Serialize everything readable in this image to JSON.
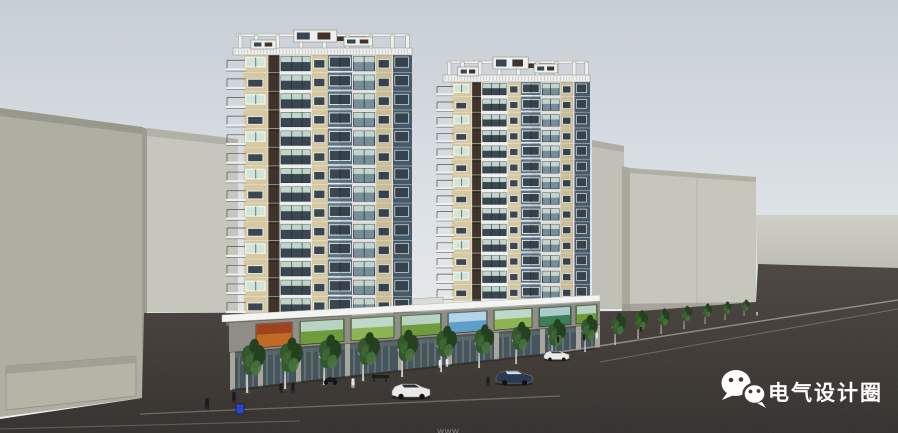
{
  "watermark": {
    "icon": "wechat-icon",
    "text": "电气设计圈",
    "color": "#ffffff"
  },
  "footer": {
    "text": "www"
  },
  "palette": {
    "sky_top": "#c7ced5",
    "sky_mid": "#dde2e6",
    "sky_bottom": "#f0f1f2",
    "ground_light": "#cfcfc8",
    "ground_light2": "#bdbdb4",
    "road_light": "#4a443f",
    "road": "#3f3a36",
    "road_dark": "#322e2b",
    "curb": "#a29d96",
    "block_face": "#aeaea2",
    "block_face_light": "#c6c6bc",
    "block_fascia": "#98988c",
    "block_side": "#9c9c90",
    "tower_tan": "#d6c8a0",
    "panel_brown": "#40332a",
    "panel_blue": "#5d7485",
    "panel_blue_dark": "#4a5f6f",
    "frame_white": "#eef0ef",
    "glass_green": "#cfe5d8",
    "glass_pale": "#dfeee6",
    "glass_dark": "#3a4750",
    "glass_blue": "#7e97a4",
    "canopy": "#f4f5f3",
    "podium_wall": "#8e8e86",
    "podium_pilaster": "#a6a69c",
    "podium_dark": "#565650",
    "store_glass": "#46555b",
    "store_mullion": "#cdd2cc",
    "sign_orange": "#c06a25",
    "sign_orange2": "#93351d",
    "sign_green": "#6e9c3c",
    "sign_green2": "#8cb455",
    "sign_teal": "#3e7d5a",
    "sign_sky": "#cfe6f0",
    "sign_blue": "#5f9ec9",
    "tree_dark": "#24401f",
    "tree_mid": "#33582b",
    "tree_light": "#4a7440",
    "trunk": "#c9c9bf",
    "car_white": "#e9eae8",
    "car_blue": "#2a3a55",
    "figure_dark": "#1c1c1e",
    "figure_light": "#e8e8e6",
    "bin_blue": "#2746c8",
    "watermark": "#ffffff"
  }
}
